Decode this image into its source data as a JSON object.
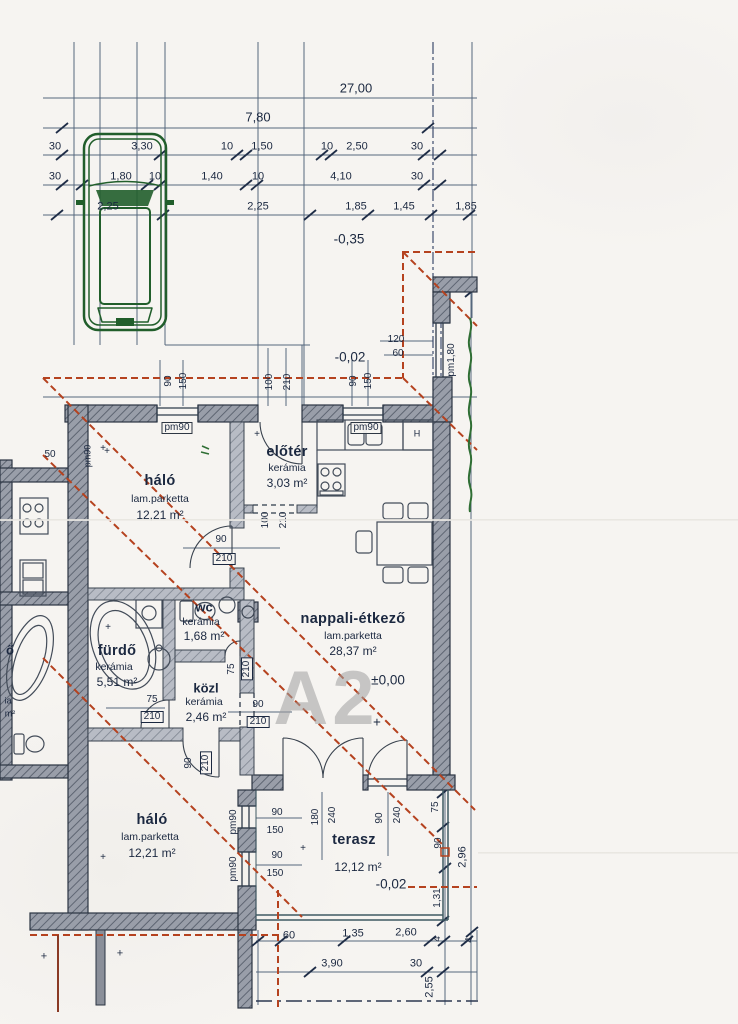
{
  "unit": {
    "code": "A2",
    "level_main": "±0,00"
  },
  "levels": {
    "parking": "-0,35",
    "entry_walk": "-0,02",
    "terrace": "-0,02"
  },
  "dims": {
    "total": "27,00",
    "sub_total": "7,80",
    "rowA": [
      "30",
      "3,30",
      "10",
      "1,50",
      "10",
      "2,50",
      "30"
    ],
    "rowB": [
      "30",
      "1,80",
      "10",
      "1,40",
      "10",
      "4,10",
      "30"
    ],
    "rowC": [
      "2,25",
      "2,25",
      "1,85",
      "1,45",
      "1,85"
    ],
    "pillar_w": "120",
    "pillar_h": "60",
    "right": {
      "a": "75",
      "b": "90",
      "c": "1,31",
      "total": "2,96",
      "tick_a": "4",
      "tick_b": "4",
      "depth": "2,55"
    },
    "bottom": {
      "a": "60",
      "b": "1,35",
      "c": "2,60",
      "total": "3,90",
      "edge": "30"
    },
    "neighbor_50": "50"
  },
  "rooms": {
    "halo1": {
      "name": "háló",
      "finish": "lam.parketta",
      "area": "12,21 m²"
    },
    "eloter": {
      "name": "előtér",
      "finish": "kerámia",
      "area": "3,03 m²"
    },
    "nappali": {
      "name": "nappali-étkező",
      "finish": "lam.parketta",
      "area": "28,37 m²"
    },
    "wc": {
      "name": "wc",
      "finish": "kerámia",
      "area": "1,68 m²"
    },
    "furdo": {
      "name": "fürdő",
      "finish": "kerámia",
      "area": "5,51 m²"
    },
    "kozl": {
      "name": "közl",
      "finish": "kerámia",
      "area": "2,46 m²"
    },
    "halo2": {
      "name": "háló",
      "finish": "lam.parketta",
      "area": "12,21 m²"
    },
    "terasz": {
      "name": "terasz",
      "area": "12,12 m²"
    }
  },
  "openings": {
    "win_w": "90",
    "win_h": "150",
    "sill90": "pm90",
    "sill180": "pm1,80",
    "entry_w": "100",
    "entry_h": "210",
    "door90_w": "90",
    "door90_h": "210",
    "door75_w": "75",
    "door75_h": "210",
    "terrace_door_w": "180",
    "terrace_door_h": "240",
    "terrace_win_w": "90",
    "terrace_win_h": "240"
  },
  "kitchen": {
    "fridge": "H"
  },
  "neighbor": {
    "label_cut1": "ő",
    "label_cut2": "ia",
    "label_cut3": "m²",
    "sill": "pm90"
  },
  "marks": {
    "plus": "+"
  }
}
